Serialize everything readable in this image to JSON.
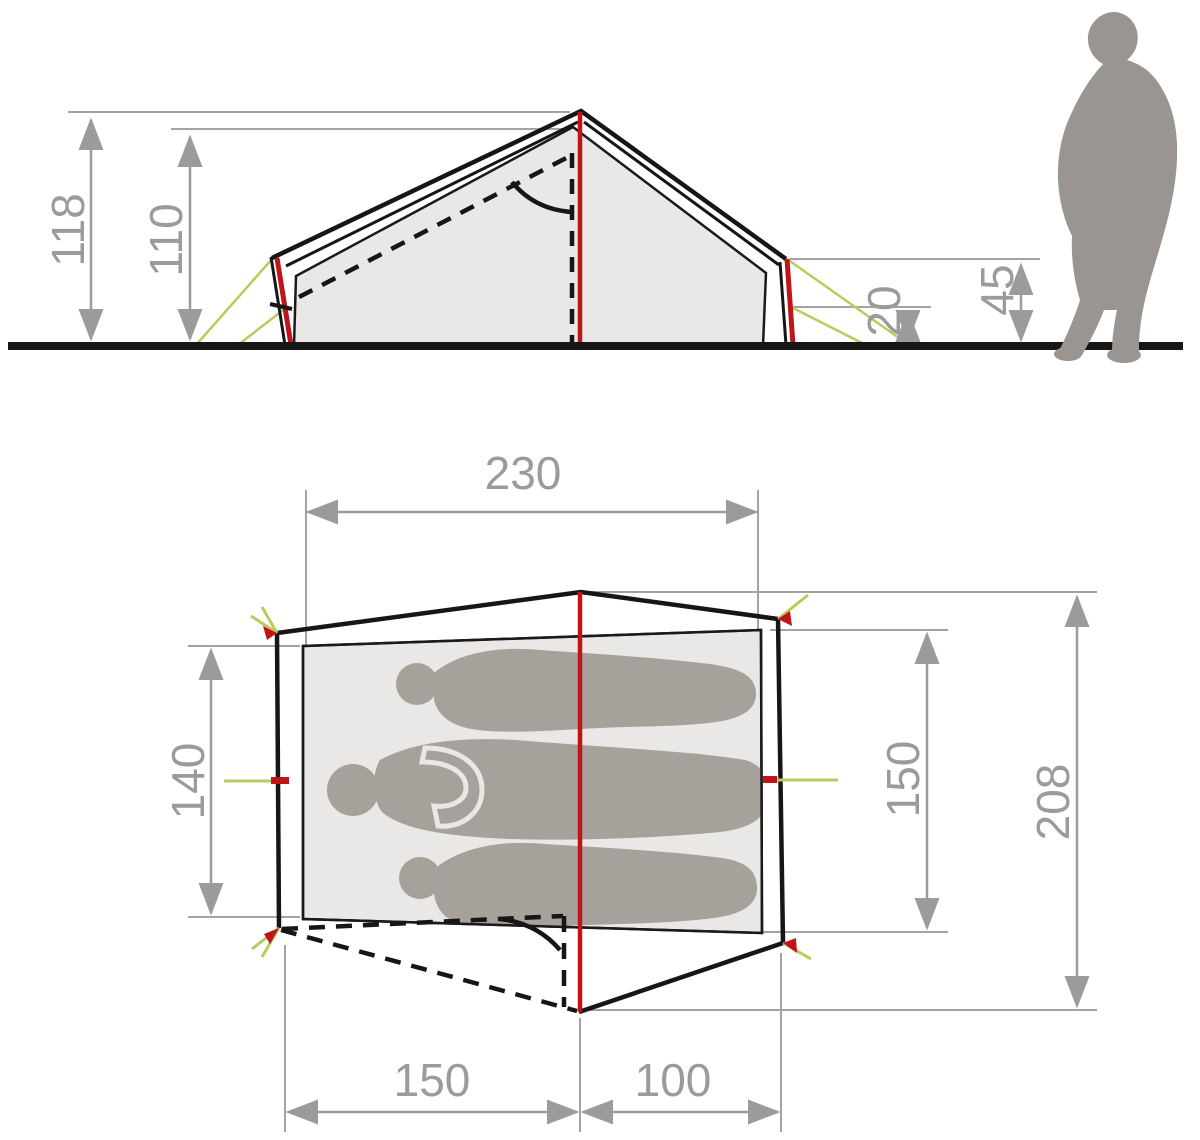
{
  "diagram": {
    "title": "tent-dimensions-diagram",
    "side_view": {
      "peak_height": "118",
      "inner_height": "110",
      "side_wall_height": "20",
      "vent_height": "45"
    },
    "top_view": {
      "inner_length": "230",
      "inner_width_left": "140",
      "inner_width_right": "150",
      "outer_length": "208",
      "floor_depth": "150",
      "vestibule_depth": "100"
    },
    "colors": {
      "red": "#bf1418",
      "guy_line": "#bdc95c",
      "dim": "#9b9b9b",
      "fill_light": "#eae8e6",
      "people": "#a7a19b",
      "person": "#9a9590",
      "line": "#161616"
    }
  }
}
